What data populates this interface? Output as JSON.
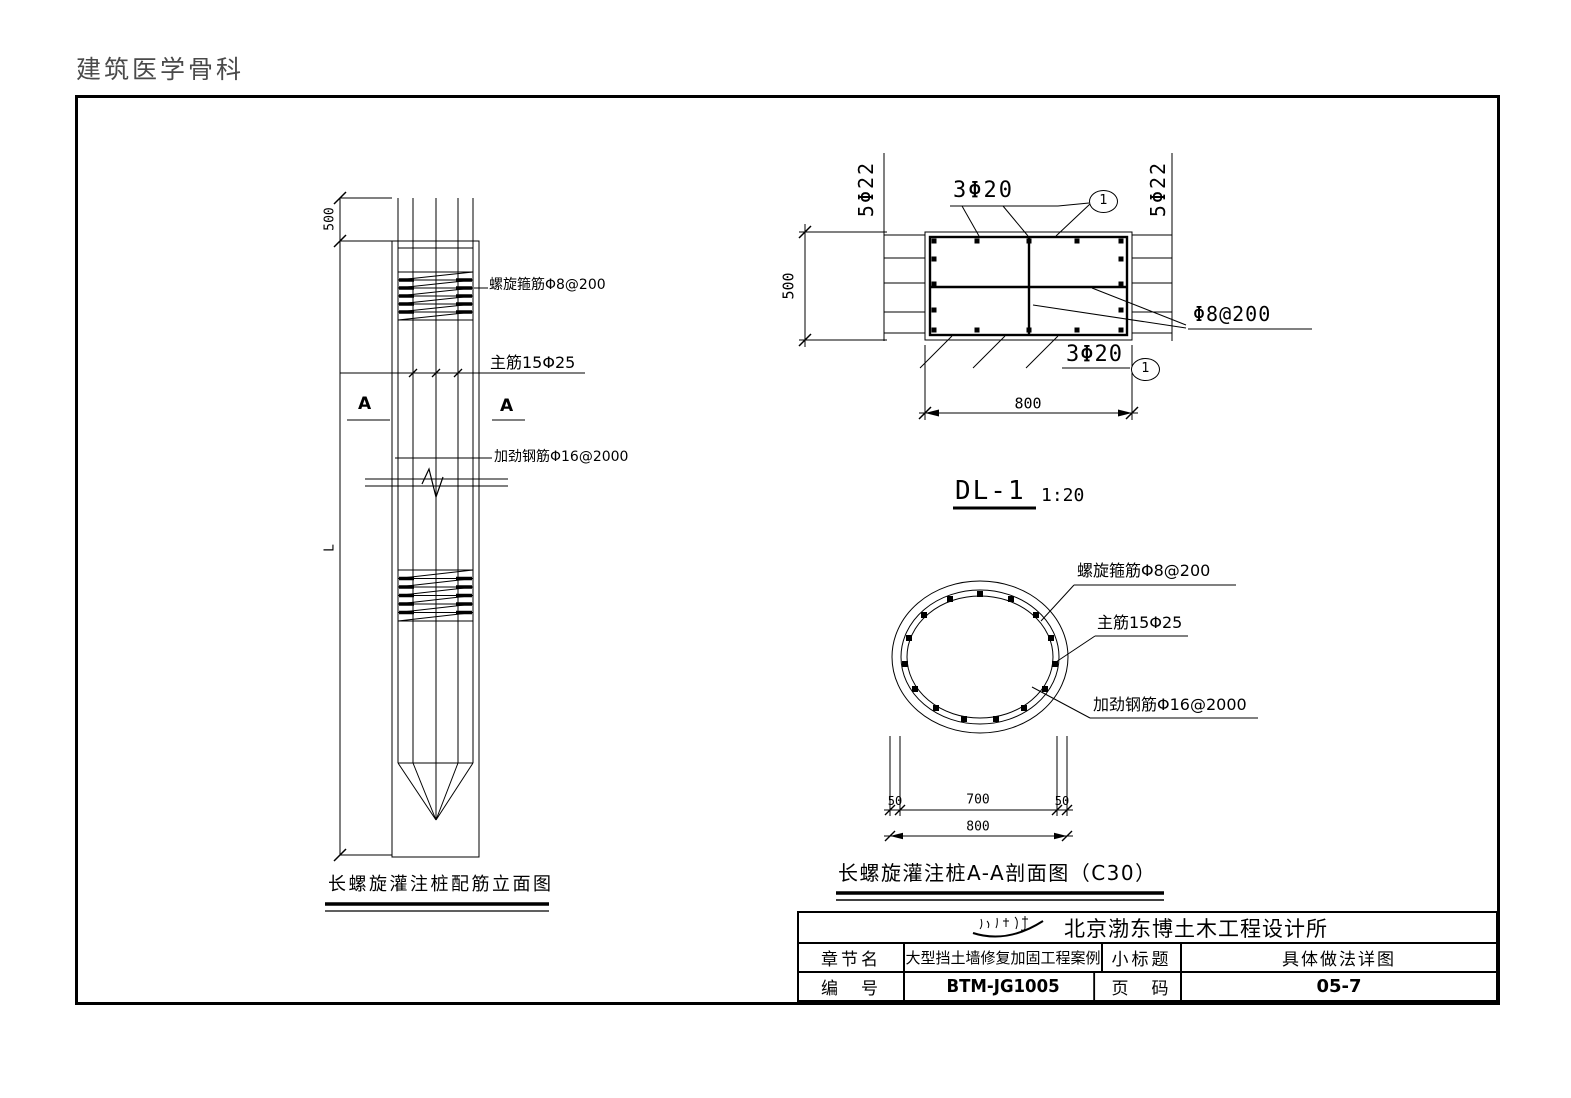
{
  "page": {
    "header": "建筑医学骨科",
    "line_color": "#000000",
    "background": "#ffffff"
  },
  "elevation": {
    "dim_top": "500",
    "dim_length": "L",
    "spiral_label": "螺旋箍筋Φ8@200",
    "main_bar_label": "主筋15Φ25",
    "stiffener_label": "加劲钢筋Φ16@2000",
    "section_mark": "A",
    "caption": "长螺旋灌注桩配筋立面图"
  },
  "beam_detail": {
    "side_bars_left": "5Φ22",
    "side_bars_right": "5Φ22",
    "top_bars": "3Φ20",
    "bottom_bars": "3Φ20",
    "stirrup_label": "Φ8@200",
    "dim_height": "500",
    "dim_width": "800",
    "callout_top": "1",
    "callout_bottom": "1",
    "name": "DL-1",
    "scale": "1:20"
  },
  "pile_section": {
    "spiral_label": "螺旋箍筋Φ8@200",
    "main_bar_label": "主筋15Φ25",
    "stiffener_label": "加劲钢筋Φ16@2000",
    "dim_cover_left": "50",
    "dim_core": "700",
    "dim_cover_right": "50",
    "dim_total": "800",
    "caption": "长螺旋灌注桩A-A剖面图（C30）"
  },
  "title_block": {
    "company": "北京渤东博土木工程设计所",
    "chapter_label": "章节名",
    "chapter_value": "大型挡土墙修复加固工程案例",
    "subtitle_label": "小标题",
    "subtitle_value": "具体做法详图",
    "number_label": "编　号",
    "number_value": "BTM-JG1005",
    "page_label": "页　码",
    "page_value": "05-7"
  }
}
